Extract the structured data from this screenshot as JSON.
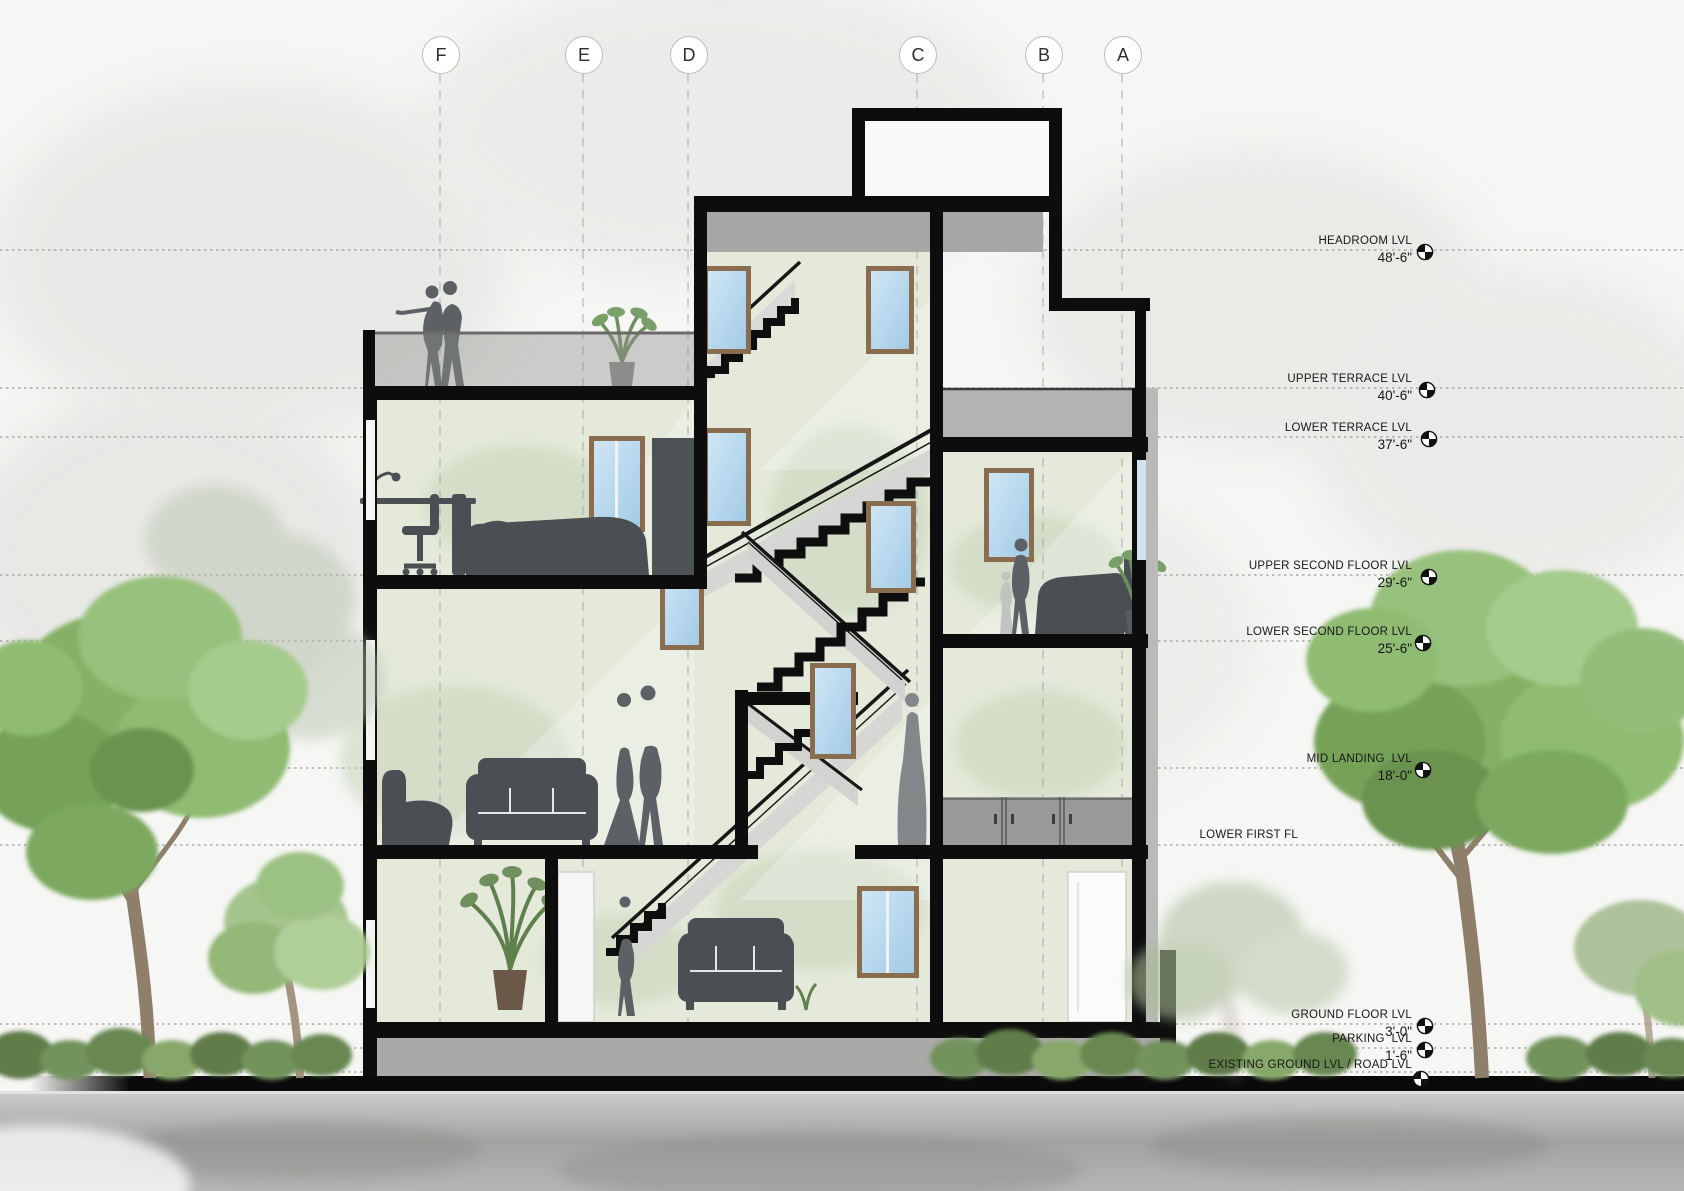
{
  "grid_markers": [
    {
      "label": "F"
    },
    {
      "label": "E"
    },
    {
      "label": "D"
    },
    {
      "label": "C"
    },
    {
      "label": "B"
    },
    {
      "label": "A"
    }
  ],
  "levels": [
    {
      "name": "HEADROOM LVL",
      "elevation": "48'-6\""
    },
    {
      "name": "UPPER TERRACE LVL",
      "elevation": "40'-6\""
    },
    {
      "name": "LOWER TERRACE LVL",
      "elevation": "37'-6\""
    },
    {
      "name": "UPPER SECOND FLOOR LVL",
      "elevation": "29'-6\""
    },
    {
      "name": "LOWER SECOND FLOOR LVL",
      "elevation": "25'-6\""
    },
    {
      "name": "MID LANDING  LVL",
      "elevation": "18'-0\""
    },
    {
      "name": "LOWER FIRST FL",
      "elevation": ""
    },
    {
      "name": "GROUND FLOOR LVL",
      "elevation": "3'-0\""
    },
    {
      "name": "PARKING  LVL",
      "elevation": "1'-6\""
    },
    {
      "name": "EXISTING GROUND LVL / ROAD LVL",
      "elevation": ""
    }
  ],
  "palette": {
    "cut_wall_black": "#0d0d0d",
    "interior_wall_green": "#e4e9da",
    "window_glass_blue": "#b7d8ef",
    "window_frame_tan": "#8a6d4e",
    "concrete_gray": "#a6a6a4",
    "foliage_green": "#86b068",
    "silhouette_gray": "#4a4f53",
    "ground_band_black": "#0a0a0a"
  },
  "icons": {
    "level_marker": "level-target-icon",
    "grid_marker": "grid-bubble"
  }
}
